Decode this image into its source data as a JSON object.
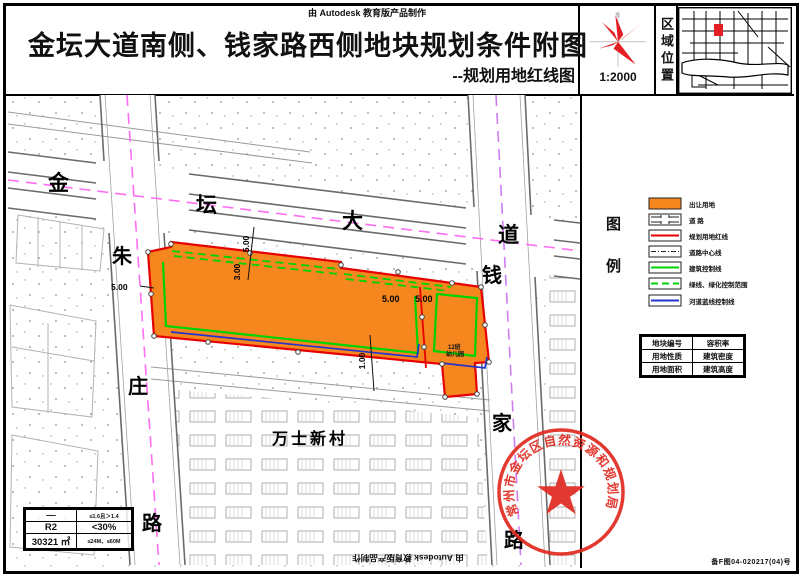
{
  "header": {
    "made_by": "由 Autodesk 教育版产品制作",
    "title": "金坛大道南侧、钱家路西侧地块规划条件附图",
    "subtitle": "--规划用地红线图",
    "scale": "1:2000",
    "north": "N",
    "region_label": "区域位置"
  },
  "map": {
    "north_road": [
      "金",
      "坛",
      "大",
      "道"
    ],
    "west_road": [
      "朱",
      "庄",
      "路"
    ],
    "east_road": [
      "钱",
      "家",
      "路"
    ],
    "village": "万士新村",
    "site_label_1": "12班",
    "site_label_2": "幼儿园",
    "dims": {
      "left": "5.00",
      "top_a": "5.00",
      "top_b": "3.00",
      "right_a": "5.00",
      "right_b": "5.00",
      "bottom": "1.00"
    }
  },
  "legend": {
    "title_top": "图",
    "title_bottom": "例",
    "items": [
      {
        "swatch": "orange-fill",
        "label": "出让用地"
      },
      {
        "swatch": "road-symbol",
        "label": "道  路"
      },
      {
        "swatch": "red-line",
        "label": "规划用地红线"
      },
      {
        "swatch": "center-line",
        "label": "道路中心线"
      },
      {
        "swatch": "green-line",
        "label": "建筑控制线"
      },
      {
        "swatch": "green-dash",
        "label": "绿线、绿化控制范围"
      },
      {
        "swatch": "blue-line",
        "label": "河道蓝线控制线"
      }
    ]
  },
  "param_table": {
    "rows": [
      [
        "地块编号",
        "容积率"
      ],
      [
        "用地性质",
        "建筑密度"
      ],
      [
        "用地面积",
        "建筑高度"
      ]
    ]
  },
  "value_table": {
    "rows": [
      [
        "—",
        "≤1.6且＞1.4"
      ],
      [
        "R2",
        "<30%"
      ],
      [
        "30321 ㎡",
        "≤24M、≤60M"
      ]
    ]
  },
  "stamp": {
    "text": "常州市金坛区自然资源和规划局"
  },
  "footer": {
    "made_by": "由 Autodesk 教育版产品制作",
    "drawing_no": "备F图04-020217(04)号"
  },
  "colors": {
    "parcel_orange": "#F6871F",
    "red_line": "#E60000",
    "green_line": "#00D400",
    "blue_line": "#2234CC",
    "centerline_magenta": "#FF6EF2",
    "stamp_red": "#E02A20"
  }
}
